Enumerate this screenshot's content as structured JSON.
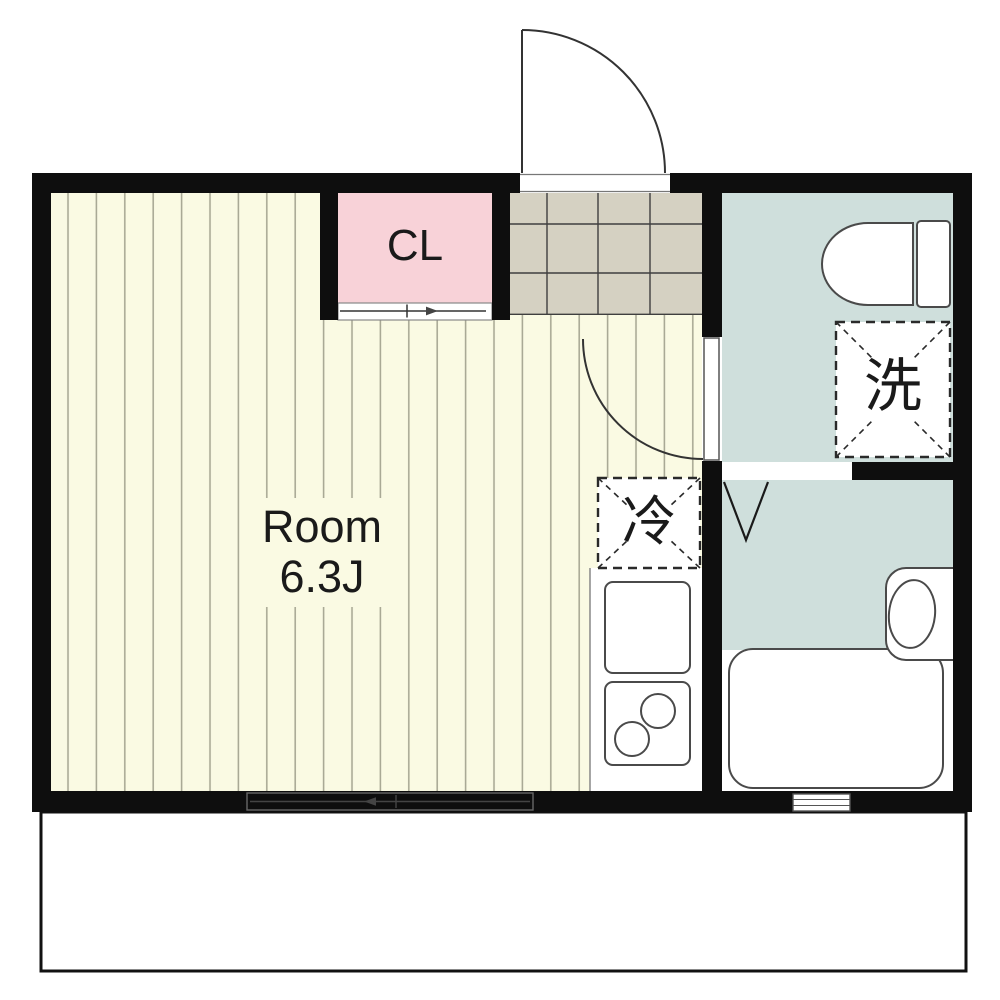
{
  "title": "apartment-floor-plan",
  "labels": {
    "room_name": "Room",
    "room_size": "6.3J",
    "closet": "CL",
    "washer": "洗",
    "fridge": "冷"
  },
  "colors": {
    "wall": "#0e0e0e",
    "floor": "#fafae3",
    "floor_stripe": "#a9a995",
    "closet": "#f8d2d8",
    "tile": "#d5d1c2",
    "tile_line": "#3f3f3f",
    "wet_area": "#cfdfdc",
    "fixture_outline": "#4a4a4a",
    "text": "#1a1a1a",
    "balcony_border": "#111111"
  }
}
